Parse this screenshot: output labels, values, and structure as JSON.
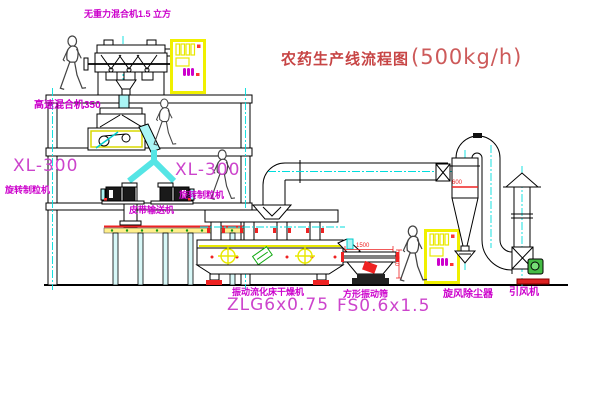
{
  "title": {
    "name": "农药生产线流程图",
    "capacity": "(500kg/h)"
  },
  "labels": {
    "gravity_mixer": "无重力混合机1.5 立方",
    "high_speed_mixer": "高速混合机350",
    "granulator_left": {
      "model": "XL-300",
      "name": "旋转制粒机"
    },
    "granulator_right": {
      "model": "XL-300",
      "name": "旋转制粒机"
    },
    "belt_conveyor": "皮带输送机",
    "dryer": {
      "name": "振动流化床干燥机",
      "model": "ZLG6x0.75"
    },
    "sieve": {
      "name": "方形振动筛",
      "model": "FS0.6x1.5"
    },
    "cyclone": "旋风除尘器",
    "fan": "引风机"
  },
  "dimensions": {
    "sieve_length": "1500",
    "sieve_height": "540",
    "cyclone_diameter": "600"
  },
  "colors": {
    "label_magenta": "#cc00cc",
    "title_red": "#c74545",
    "machine_yellow": "#f0f000",
    "centerline_cyan": "#00dddd",
    "detail_red": "#ee2222",
    "motor_green": "#44bb44"
  }
}
